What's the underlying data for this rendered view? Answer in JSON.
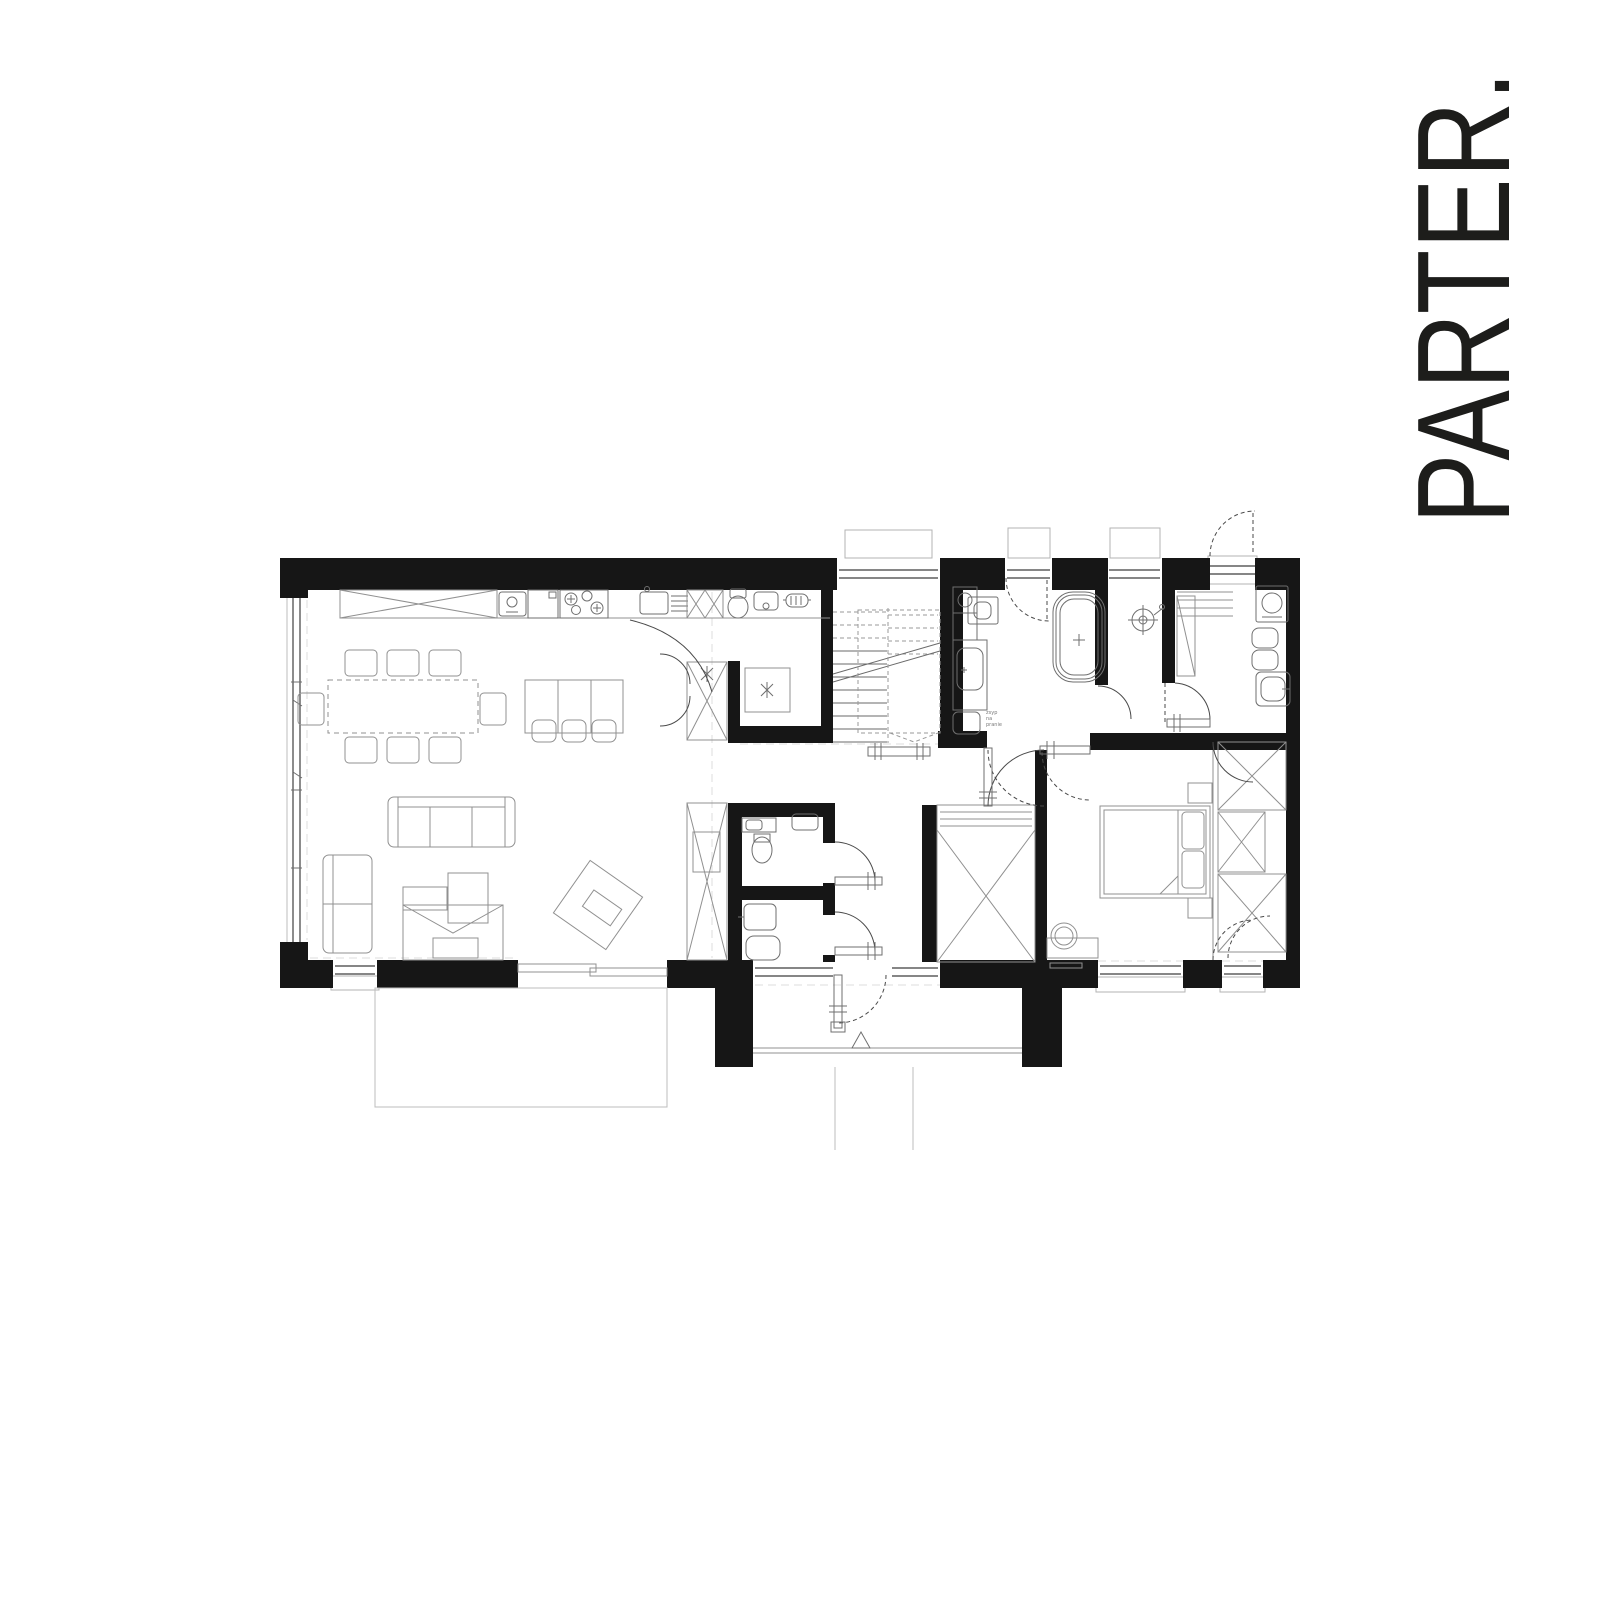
{
  "title": "PARTER.",
  "annotations": {
    "laundry_chute": {
      "line1": "zsyp",
      "line2": "na",
      "line3": "pranie"
    }
  },
  "colors": {
    "background": "#ffffff",
    "ink": "#161616",
    "furniture": "#909090",
    "fixture": "#6f6f6f",
    "door": "#4a4a4a",
    "guide": "#dcdcdc",
    "sill": "#b3b3b3",
    "title_color": "#1d1d1b"
  }
}
